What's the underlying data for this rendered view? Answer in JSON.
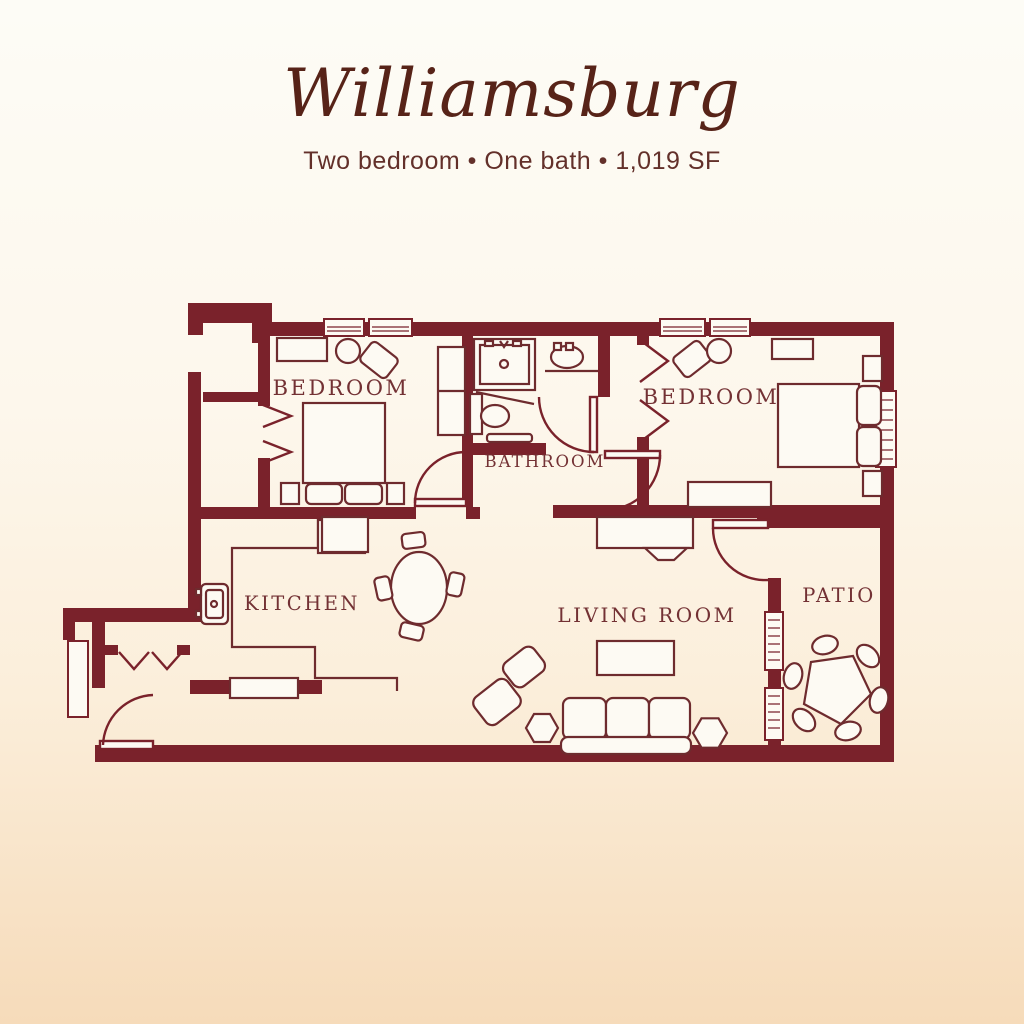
{
  "header": {
    "title": "Williamsburg",
    "subtitle": "Two bedroom • One bath • 1,019 SF"
  },
  "floorplan": {
    "rooms": {
      "bedroom_left": "BEDROOM",
      "bathroom": "BATHROOM",
      "bedroom_right": "BEDROOM",
      "kitchen": "KITCHEN",
      "living_room": "LIVING ROOM",
      "patio": "PATIO"
    },
    "features": [
      "entry-door",
      "bedroom-doors",
      "bathroom-door",
      "patio-door",
      "bifold-closets",
      "windows",
      "shower",
      "toilet",
      "sink",
      "beds",
      "sofa",
      "coffee-table",
      "dining-table",
      "patio-table"
    ]
  },
  "colors": {
    "wall": "#7a222b",
    "furniture_line": "#6e2b2e",
    "label_text": "#733134",
    "title_text": "#572318",
    "subtitle_text": "#63302a",
    "background_top": "#fdfcf6",
    "background_bottom": "#f6dbba"
  }
}
